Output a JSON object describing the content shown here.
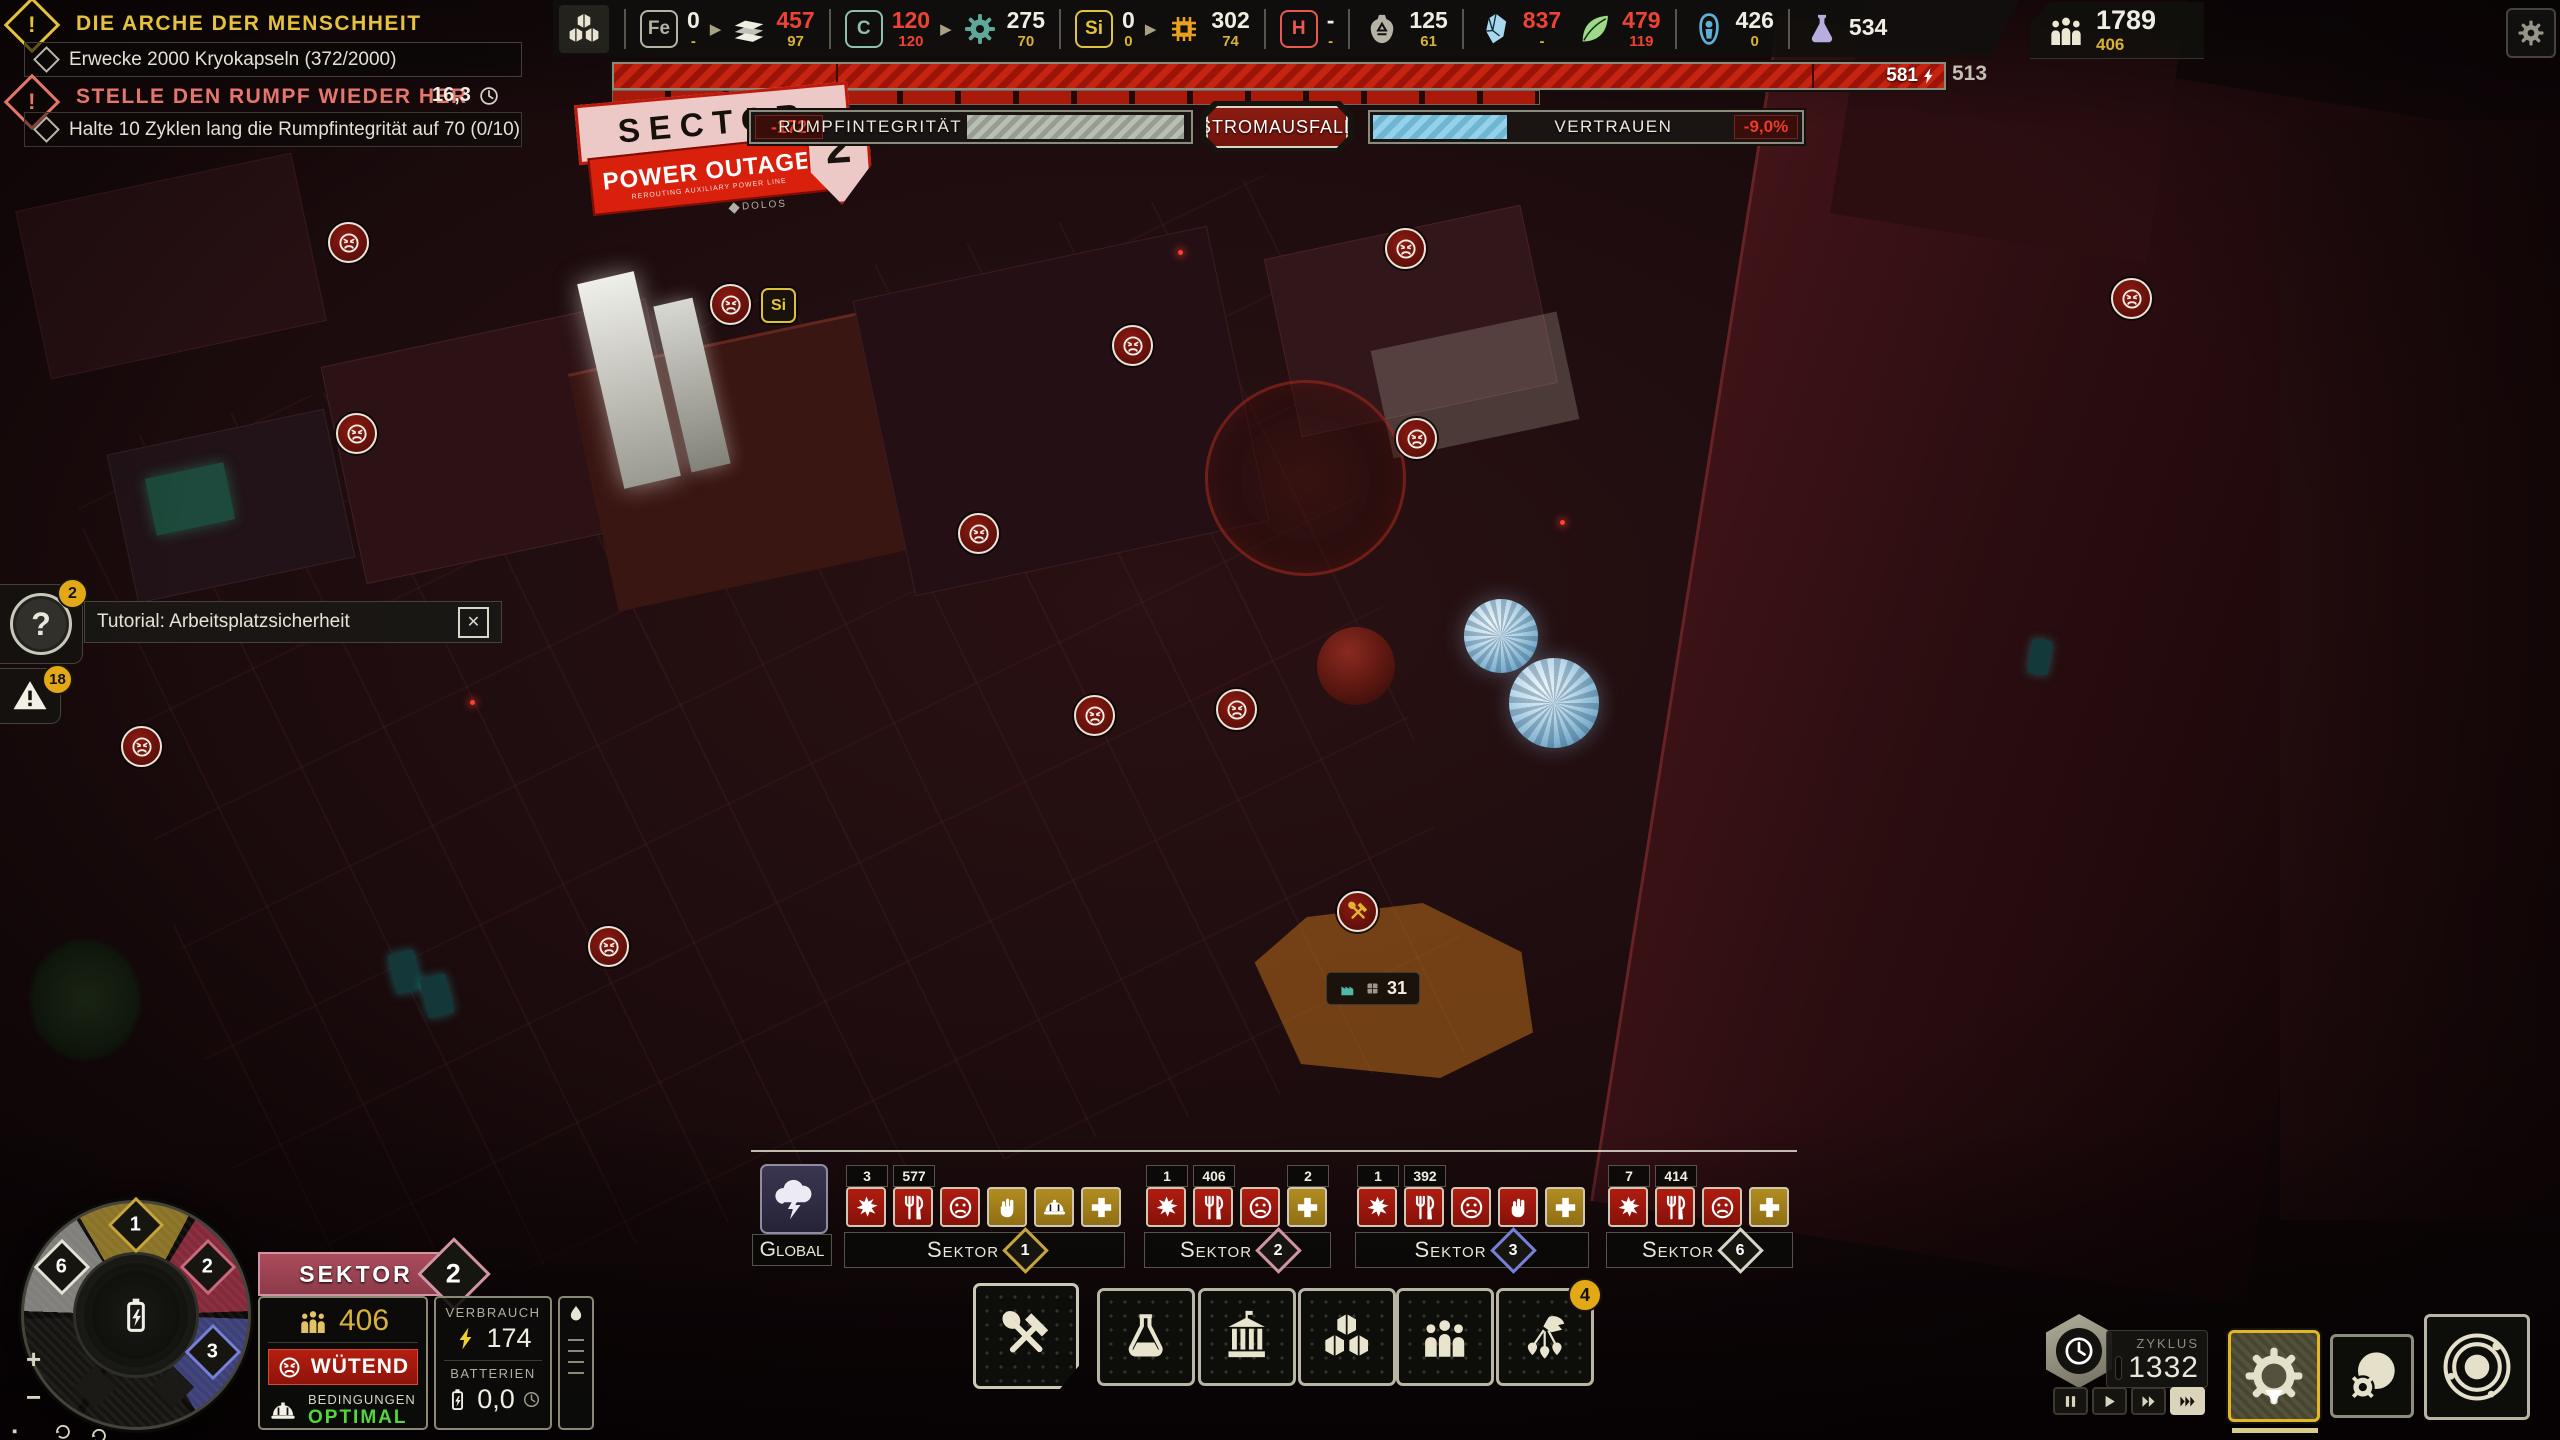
{
  "quests": {
    "q1": {
      "title": "DIE ARCHE DER MENSCHHEIT",
      "objective": "Erwecke 2000 Kryokapseln (372/2000)"
    },
    "q2": {
      "title": "STELLE DEN RUMPF WIEDER HER",
      "timer": "16,3",
      "objective": "Halte 10 Zyklen lang die Rumpfintegrität auf 70 (0/10)"
    }
  },
  "resource_bar": {
    "items": [
      {
        "name": "eisen",
        "letter": "Fe",
        "letter_color": "#b5b2a6",
        "value": "0",
        "sub": "-",
        "value_color": "white",
        "sub_color": "yellow",
        "arrow_after": true
      },
      {
        "name": "legierung",
        "icon": "alloy-icon",
        "icon_color": "#f0ede2",
        "value": "457",
        "sub": "97",
        "value_color": "red",
        "sub_color": "yellow",
        "sep_after": true
      },
      {
        "name": "kohlenstoff",
        "letter": "C",
        "letter_color": "#8fbfb0",
        "value": "120",
        "sub": "120",
        "value_color": "red",
        "sub_color": "red",
        "arrow_after": true
      },
      {
        "name": "elektronik",
        "icon": "gear-icon",
        "icon_color": "#5fa899",
        "value": "275",
        "sub": "70",
        "value_color": "white",
        "sub_color": "yellow",
        "sep_after": true
      },
      {
        "name": "silizium",
        "letter": "Si",
        "letter_color": "#e0c43c",
        "value": "0",
        "sub": "0",
        "value_color": "white",
        "sub_color": "yellow",
        "arrow_after": true
      },
      {
        "name": "polymer",
        "icon": "chip-icon",
        "icon_color": "#e8a01e",
        "value": "302",
        "sub": "74",
        "value_color": "white",
        "sub_color": "yellow",
        "sep_after": true
      },
      {
        "name": "wasserstoff",
        "letter": "H",
        "letter_color": "#e85a4e",
        "value": "-",
        "sub": "-",
        "value_color": "white",
        "sub_color": "yellow",
        "sep_after": true
      },
      {
        "name": "abfall",
        "icon": "waste-icon",
        "icon_color": "#b5b2a6",
        "value": "125",
        "sub": "61",
        "value_color": "white",
        "sub_color": "yellow",
        "sep_after": true
      },
      {
        "name": "eis",
        "icon": "ice-icon",
        "icon_color": "#a8d8ee",
        "value": "837",
        "sub": "-",
        "value_color": "red",
        "sub_color": "yellow"
      },
      {
        "name": "nahrung",
        "icon": "food-icon",
        "icon_color": "#9ed98a",
        "value": "479",
        "sub": "119",
        "value_color": "red",
        "sub_color": "red",
        "sep_after": true
      },
      {
        "name": "kryokapseln",
        "icon": "cryo-icon",
        "icon_color": "#5fb0d8",
        "value": "426",
        "sub": "0",
        "value_color": "white",
        "sub_color": "yellow",
        "sep_after": true
      },
      {
        "name": "wissenschaft",
        "icon": "science-icon",
        "icon_color": "#b8aede",
        "value": "534",
        "sub": "",
        "value_color": "white",
        "sub_color": "yellow"
      }
    ],
    "population": {
      "value": "1789",
      "sub": "406"
    }
  },
  "power": {
    "current": "581",
    "capacity": "513"
  },
  "status": {
    "sector_sign": {
      "line1": "SECTOR",
      "line2": "POWER OUTAGE",
      "line3": "REROUTING AUXILIARY POWER LINE",
      "number": "2",
      "brand": "DOLOS"
    },
    "hull": {
      "label": "RUMPFINTEGRITÄT",
      "delta": "-172"
    },
    "outage": {
      "label": "STROMAUSFALL"
    },
    "trust": {
      "label": "VERTRAUEN",
      "delta": "-9,0%",
      "fill_pct": 31
    }
  },
  "notifications": {
    "tutorial": {
      "text": "Tutorial: Arbeitsplatzsicherheit",
      "badge": "2"
    },
    "alerts": {
      "badge": "18"
    }
  },
  "map": {
    "markers": [
      {
        "x": 346,
        "y": 240
      },
      {
        "x": 728,
        "y": 302
      },
      {
        "x": 1130,
        "y": 343
      },
      {
        "x": 1403,
        "y": 246
      },
      {
        "x": 1414,
        "y": 436
      },
      {
        "x": 2129,
        "y": 296
      },
      {
        "x": 354,
        "y": 431
      },
      {
        "x": 976,
        "y": 531
      },
      {
        "x": 1092,
        "y": 713
      },
      {
        "x": 1234,
        "y": 707
      },
      {
        "x": 139,
        "y": 744
      },
      {
        "x": 606,
        "y": 944
      }
    ],
    "si_badge": {
      "label": "Si",
      "x": 761,
      "y": 288
    },
    "zone_marker": {
      "x": 1355,
      "y": 909
    },
    "zone_tooltip": {
      "value": "31",
      "x": 1326,
      "y": 972
    }
  },
  "sector_status": {
    "global_label": "Global",
    "groups": [
      {
        "name": "Sektor",
        "num": "1",
        "color": "#c8a43c",
        "tiles": [
          {
            "icon": "burst-icon",
            "bg": "red",
            "badge": "3"
          },
          {
            "icon": "food-alert-icon",
            "bg": "red",
            "badge": "577"
          },
          {
            "icon": "sad-face-icon",
            "bg": "red"
          },
          {
            "icon": "fist-icon",
            "bg": "gold"
          },
          {
            "icon": "helmet-icon",
            "bg": "gold"
          },
          {
            "icon": "cross-icon",
            "bg": "gold"
          }
        ]
      },
      {
        "name": "Sektor",
        "num": "2",
        "color": "#d194a2",
        "tiles": [
          {
            "icon": "burst-icon",
            "bg": "red",
            "badge": "1"
          },
          {
            "icon": "food-alert-icon",
            "bg": "red",
            "badge": "406"
          },
          {
            "icon": "sad-face-icon",
            "bg": "red"
          },
          {
            "icon": "cross-icon",
            "bg": "gold",
            "badge": "2"
          }
        ]
      },
      {
        "name": "Sektor",
        "num": "3",
        "color": "#7680d8",
        "tiles": [
          {
            "icon": "burst-icon",
            "bg": "red",
            "badge": "1"
          },
          {
            "icon": "food-alert-icon",
            "bg": "red",
            "badge": "392"
          },
          {
            "icon": "sad-face-icon",
            "bg": "red"
          },
          {
            "icon": "fist-icon",
            "bg": "red"
          },
          {
            "icon": "cross-icon",
            "bg": "gold"
          }
        ]
      },
      {
        "name": "Sektor",
        "num": "6",
        "color": "#d8d5c8",
        "tiles": [
          {
            "icon": "burst-icon",
            "bg": "red",
            "badge": "7"
          },
          {
            "icon": "food-alert-icon",
            "bg": "red",
            "badge": "414"
          },
          {
            "icon": "sad-face-icon",
            "bg": "red"
          },
          {
            "icon": "cross-icon",
            "bg": "gold"
          }
        ]
      }
    ]
  },
  "build_menu": {
    "buttons": [
      {
        "name": "construction",
        "icon": "construction-icon"
      },
      {
        "name": "research",
        "icon": "research-icon"
      },
      {
        "name": "civic",
        "icon": "civic-icon"
      },
      {
        "name": "stockpile",
        "icon": "stockpile-icon"
      },
      {
        "name": "population",
        "icon": "population-icon"
      },
      {
        "name": "expedition",
        "icon": "expedition-icon",
        "badge": "4"
      }
    ]
  },
  "sector_hud": {
    "header": "SEKTOR",
    "number": "2",
    "population": "406",
    "mood": "WÜTEND",
    "conditions_label": "BEDINGUNGEN",
    "conditions_value": "OPTIMAL",
    "consumption_label": "VERBRAUCH",
    "consumption_value": "174",
    "batteries_label": "BATTERIEN",
    "batteries_value": "0,0",
    "wheel_sectors": [
      {
        "num": "1",
        "color": "#c8a43c"
      },
      {
        "num": "2",
        "color": "#c9687c"
      },
      {
        "num": "3",
        "color": "#7680d8"
      },
      {
        "num": "6",
        "color": "#e4e1d5"
      }
    ]
  },
  "time_controls": {
    "cycle_label": "ZYKLUS",
    "cycle_value": "1332"
  }
}
